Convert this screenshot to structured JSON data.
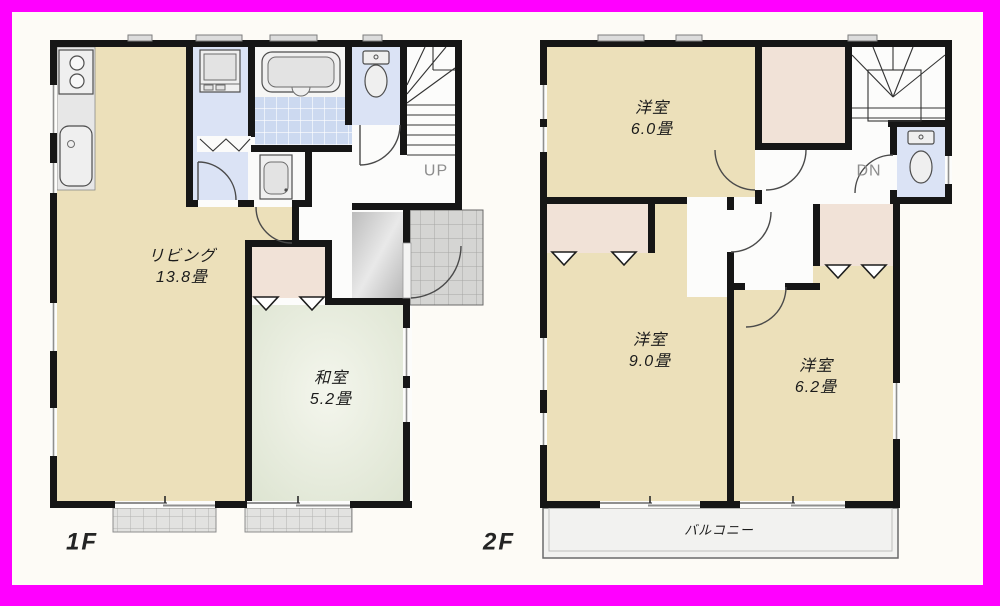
{
  "frame": {
    "color": "#ff00ff"
  },
  "colors": {
    "frame": "#ff00ff",
    "wall": "#161616",
    "room_beige": "#ece0ba",
    "washitsu_green": "#e4ead7",
    "closet_pink": "#f1e2d7",
    "water_blue": "#dbe3f5",
    "bath_tile": "#ccd9f0",
    "tile_gray": "#d5d5d3",
    "balcony_fill": "#f2f2f0"
  },
  "floor1": {
    "label": "1F",
    "stairs_label": "UP",
    "rooms": {
      "living": {
        "name": "リビング",
        "size": "13.8畳"
      },
      "washitsu": {
        "name": "和室",
        "size": "5.2畳"
      }
    }
  },
  "floor2": {
    "label": "2F",
    "stairs_label": "DN",
    "balcony_label": "バルコニー",
    "rooms": {
      "yoshitsu_60": {
        "name": "洋室",
        "size": "6.0畳"
      },
      "yoshitsu_90": {
        "name": "洋室",
        "size": "9.0畳"
      },
      "yoshitsu_62": {
        "name": "洋室",
        "size": "6.2畳"
      }
    }
  }
}
